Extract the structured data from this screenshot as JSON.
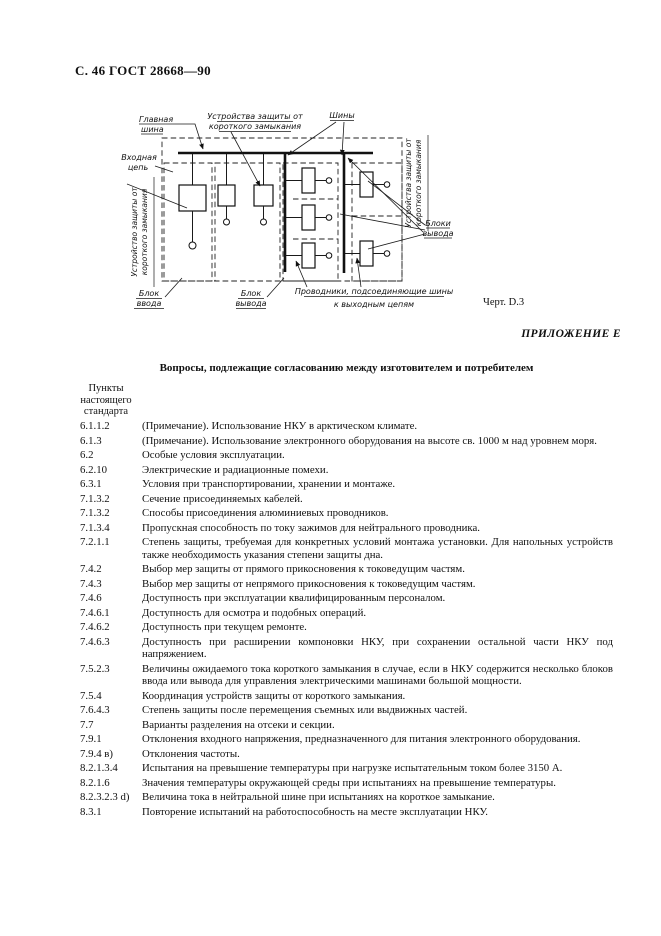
{
  "page_header": "С. 46 ГОСТ 28668—90",
  "figure": {
    "caption": "Черт. D.3",
    "labels": {
      "main_bus_l1": "Главная",
      "main_bus_l2": "шина",
      "scp_top_l1": "Устройства защиты от",
      "scp_top_l2": "короткого замыкания",
      "buses": "Шины",
      "input_circuit_l1": "Входная",
      "input_circuit_l2": "цепь",
      "scp_left_l1": "Устройство защиты от",
      "scp_left_l2": "короткого замыкания",
      "scp_right_l1": "Устройства защиты от",
      "scp_right_l2": "короткого замыкания",
      "input_unit_l1": "Блок",
      "input_unit_l2": "ввода",
      "output_unit_l1": "Блок",
      "output_unit_l2": "вывода",
      "output_units_l1": "Блоки",
      "output_units_l2": "вывода",
      "conductors_l1": "Проводники, подсоединяющие шины",
      "conductors_l2": "к выходным цепям"
    }
  },
  "appendix": {
    "label": "ПРИЛОЖЕНИЕ Е"
  },
  "section": {
    "title": "Вопросы, подлежащие согласованию между изготовителем и потребителем",
    "column_header": {
      "l1": "Пункты",
      "l2": "настоящего",
      "l3": "стандарта"
    },
    "items": [
      {
        "clause": "6.1.1.2",
        "text": "(Примечание). Использование НКУ в арктическом климате."
      },
      {
        "clause": "6.1.3",
        "text": "(Примечание). Использование электронного оборудования на высоте св. 1000 м над уровнем моря."
      },
      {
        "clause": "6.2",
        "text": "Особые условия эксплуатации."
      },
      {
        "clause": "6.2.10",
        "text": "Электрические и радиационные помехи."
      },
      {
        "clause": "6.3.1",
        "text": "Условия при транспортировании, хранении и монтаже."
      },
      {
        "clause": "7.1.3.2",
        "text": "Сечение присоединяемых кабелей."
      },
      {
        "clause": "7.1.3.2",
        "text": "Способы присоединения алюминиевых проводников."
      },
      {
        "clause": "7.1.3.4",
        "text": "Пропускная способность по току зажимов для нейтрального проводника."
      },
      {
        "clause": "7.2.1.1",
        "text": "Степень защиты, требуемая для конкретных условий монтажа установки. Для напольных устройств также необходимость указания степени защиты дна."
      },
      {
        "clause": "7.4.2",
        "text": "Выбор мер защиты от прямого прикосновения к токоведущим частям."
      },
      {
        "clause": "7.4.3",
        "text": "Выбор мер защиты от непрямого прикосновения к токоведущим частям."
      },
      {
        "clause": "7.4.6",
        "text": "Доступность при эксплуатации квалифицированным персоналом."
      },
      {
        "clause": "7.4.6.1",
        "text": "Доступность для осмотра и подобных операций."
      },
      {
        "clause": "7.4.6.2",
        "text": "Доступность при текущем ремонте."
      },
      {
        "clause": "7.4.6.3",
        "text": "Доступность при расширении компоновки НКУ, при сохранении остальной части НКУ под напряжением."
      },
      {
        "clause": "7.5.2.3",
        "text": "Величины ожидаемого тока короткого замыкания в случае, если в НКУ содержится несколько блоков ввода или вывода для управления электрическими машинами большой мощности."
      },
      {
        "clause": "7.5.4",
        "text": "Координация устройств защиты от короткого замыкания."
      },
      {
        "clause": "7.6.4.3",
        "text": "Степень защиты после перемещения съемных или выдвижных частей."
      },
      {
        "clause": "7.7",
        "text": "Варианты разделения на отсеки и секции."
      },
      {
        "clause": "7.9.1",
        "text": "Отклонения входного напряжения, предназначенного для питания электронного оборудования."
      },
      {
        "clause": "7.9.4 в)",
        "text": "Отклонения частоты."
      },
      {
        "clause": "8.2.1.3.4",
        "text": "Испытания на превышение температуры при нагрузке испытательным током более 3150 А."
      },
      {
        "clause": "8.2.1.6",
        "text": "Значения температуры окружающей среды при испытаниях на превышение температуры."
      },
      {
        "clause": "8.2.3.2.3 d)",
        "text": "Величина тока в нейтральной шине при испытаниях на короткое замыкание."
      },
      {
        "clause": "8.3.1",
        "text": "Повторение испытаний на работоспособность на месте эксплуатации НКУ."
      }
    ]
  }
}
